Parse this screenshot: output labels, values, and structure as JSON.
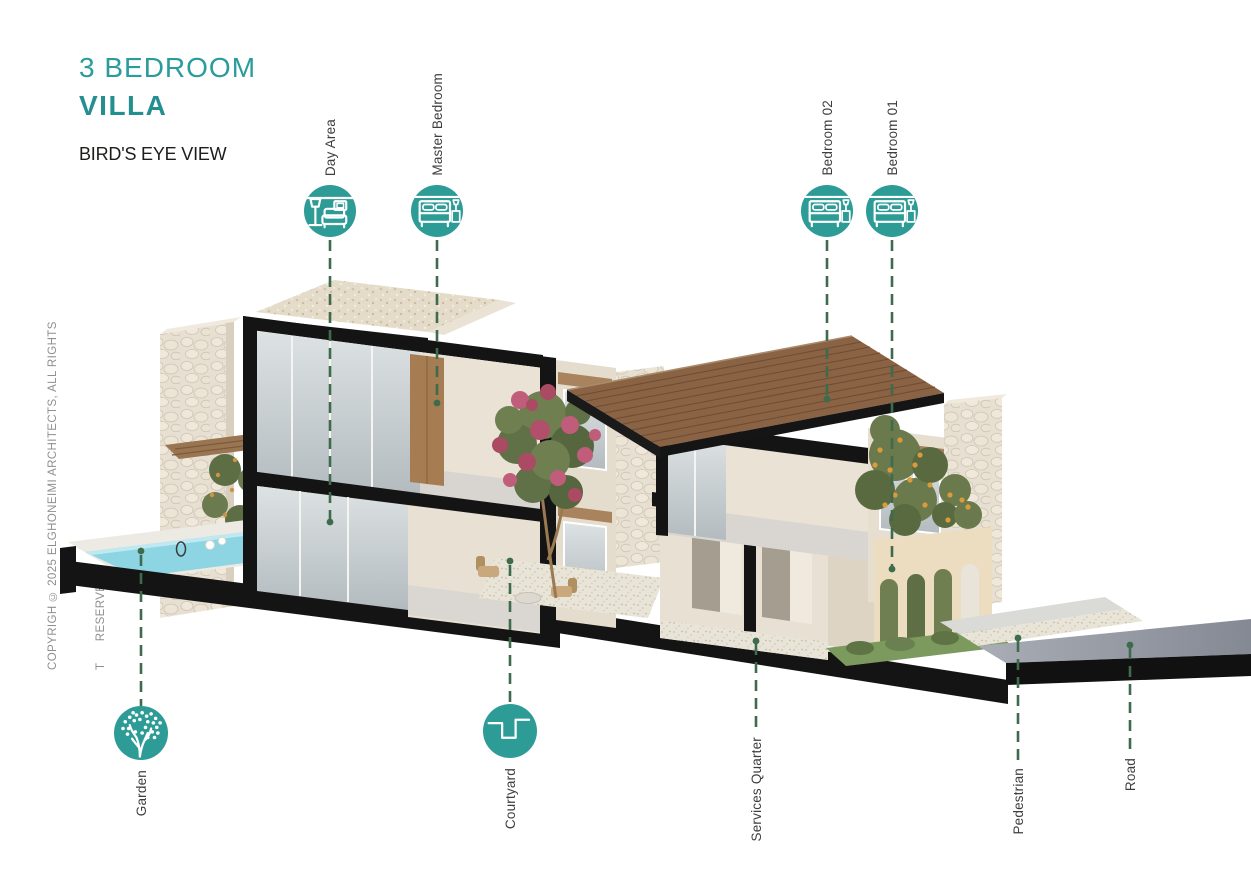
{
  "title": {
    "heading_line1": "3 BEDROOM",
    "heading_line2": "VILLA",
    "subtitle": "BIRD'S EYE VIEW"
  },
  "copyright": {
    "line1": "COPYRIGH © 2025 ELGHONEIMI ARCHITECTS, ALL RIGHTS",
    "line2": "T      RESERVED"
  },
  "colors": {
    "accent_teal": "#2d9b96",
    "callout_green": "#3e6b4e",
    "label_text": "#3e3e3e",
    "wood_roof": "#8a6244",
    "pool_water": "#8ed5e4",
    "grass": "#7d9a5e",
    "road": "#8e939d",
    "wall_cream": "#e7e0d3",
    "section_black": "#141414"
  },
  "callouts": {
    "day_area": {
      "label": "Day Area",
      "icon": "sofa-lamp-icon"
    },
    "master_bedroom": {
      "label": "Master Bedroom",
      "icon": "double-bed-icon"
    },
    "bedroom_02": {
      "label": "Bedroom 02",
      "icon": "double-bed-icon"
    },
    "bedroom_01": {
      "label": "Bedroom 01",
      "icon": "double-bed-icon"
    },
    "garden": {
      "label": "Garden",
      "icon": "tree-icon"
    },
    "courtyard": {
      "label": "Courtyard",
      "icon": "courtyard-plan-icon"
    },
    "services_quarter": {
      "label": "Services Quarter"
    },
    "pedestrian": {
      "label": "Pedestrian"
    },
    "road": {
      "label": "Road"
    }
  }
}
